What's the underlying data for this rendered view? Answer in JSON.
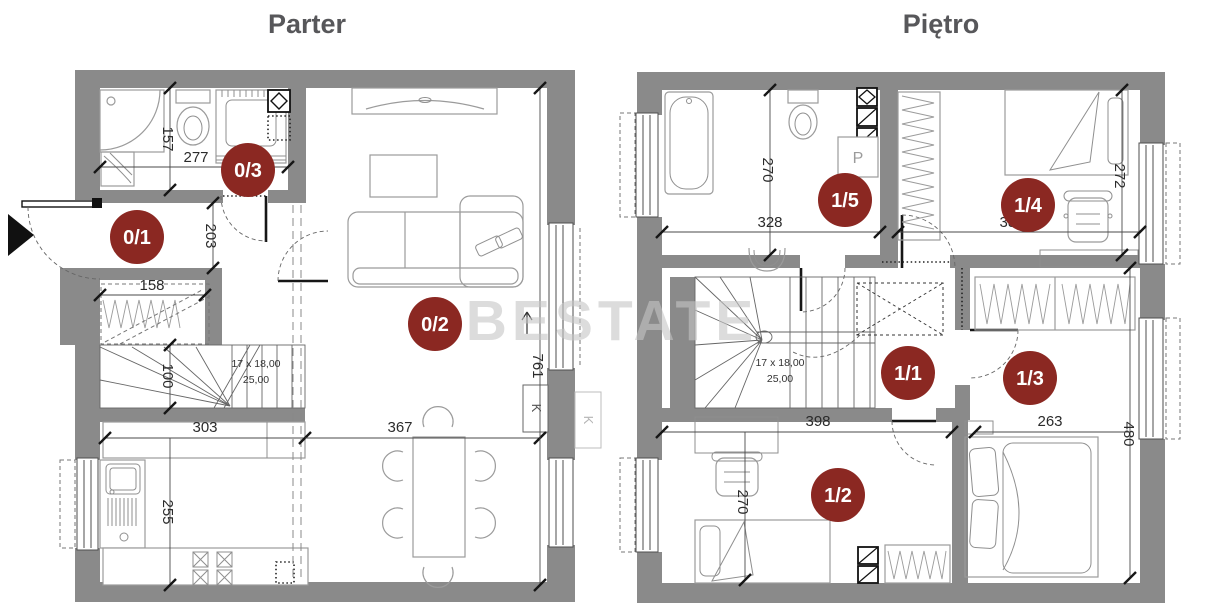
{
  "watermark": "BESTATE",
  "colors": {
    "wall": "#8a8a8a",
    "room_badge": "#8b2822",
    "badge_text": "#ffffff",
    "title": "#57575a",
    "watermark": "#c5c5c5",
    "dimension_text": "#2b2b2b"
  },
  "floors": [
    {
      "title": "Parter",
      "rooms": {
        "hall": "0/1",
        "living": "0/2",
        "bathroom": "0/3"
      },
      "dims": {
        "bath_width": "277",
        "bath_depth": "157",
        "hall_depth": "203",
        "closet_width": "158",
        "stair_run": "100",
        "kitchen_width": "303",
        "kitchen_depth": "255",
        "dining_width": "367",
        "living_depth": "761"
      },
      "stairs": {
        "line1": "17 x 18,00",
        "line2": "25,00"
      },
      "flue_label": "K"
    },
    {
      "title": "Piętro",
      "rooms": {
        "landing": "1/1",
        "bedroom_left": "1/2",
        "bedroom_right": "1/3",
        "bedroom_top": "1/4",
        "bathroom": "1/5"
      },
      "dims": {
        "bath_depth": "270",
        "bath_width": "328",
        "r4_width": "381",
        "r4_depth": "272",
        "r2_width": "398",
        "r2_depth": "270",
        "r3_width": "263",
        "right_depth": "480"
      },
      "stairs": {
        "line1": "17 x 18,00",
        "line2": "25,00"
      },
      "washer_label": "P"
    }
  ]
}
